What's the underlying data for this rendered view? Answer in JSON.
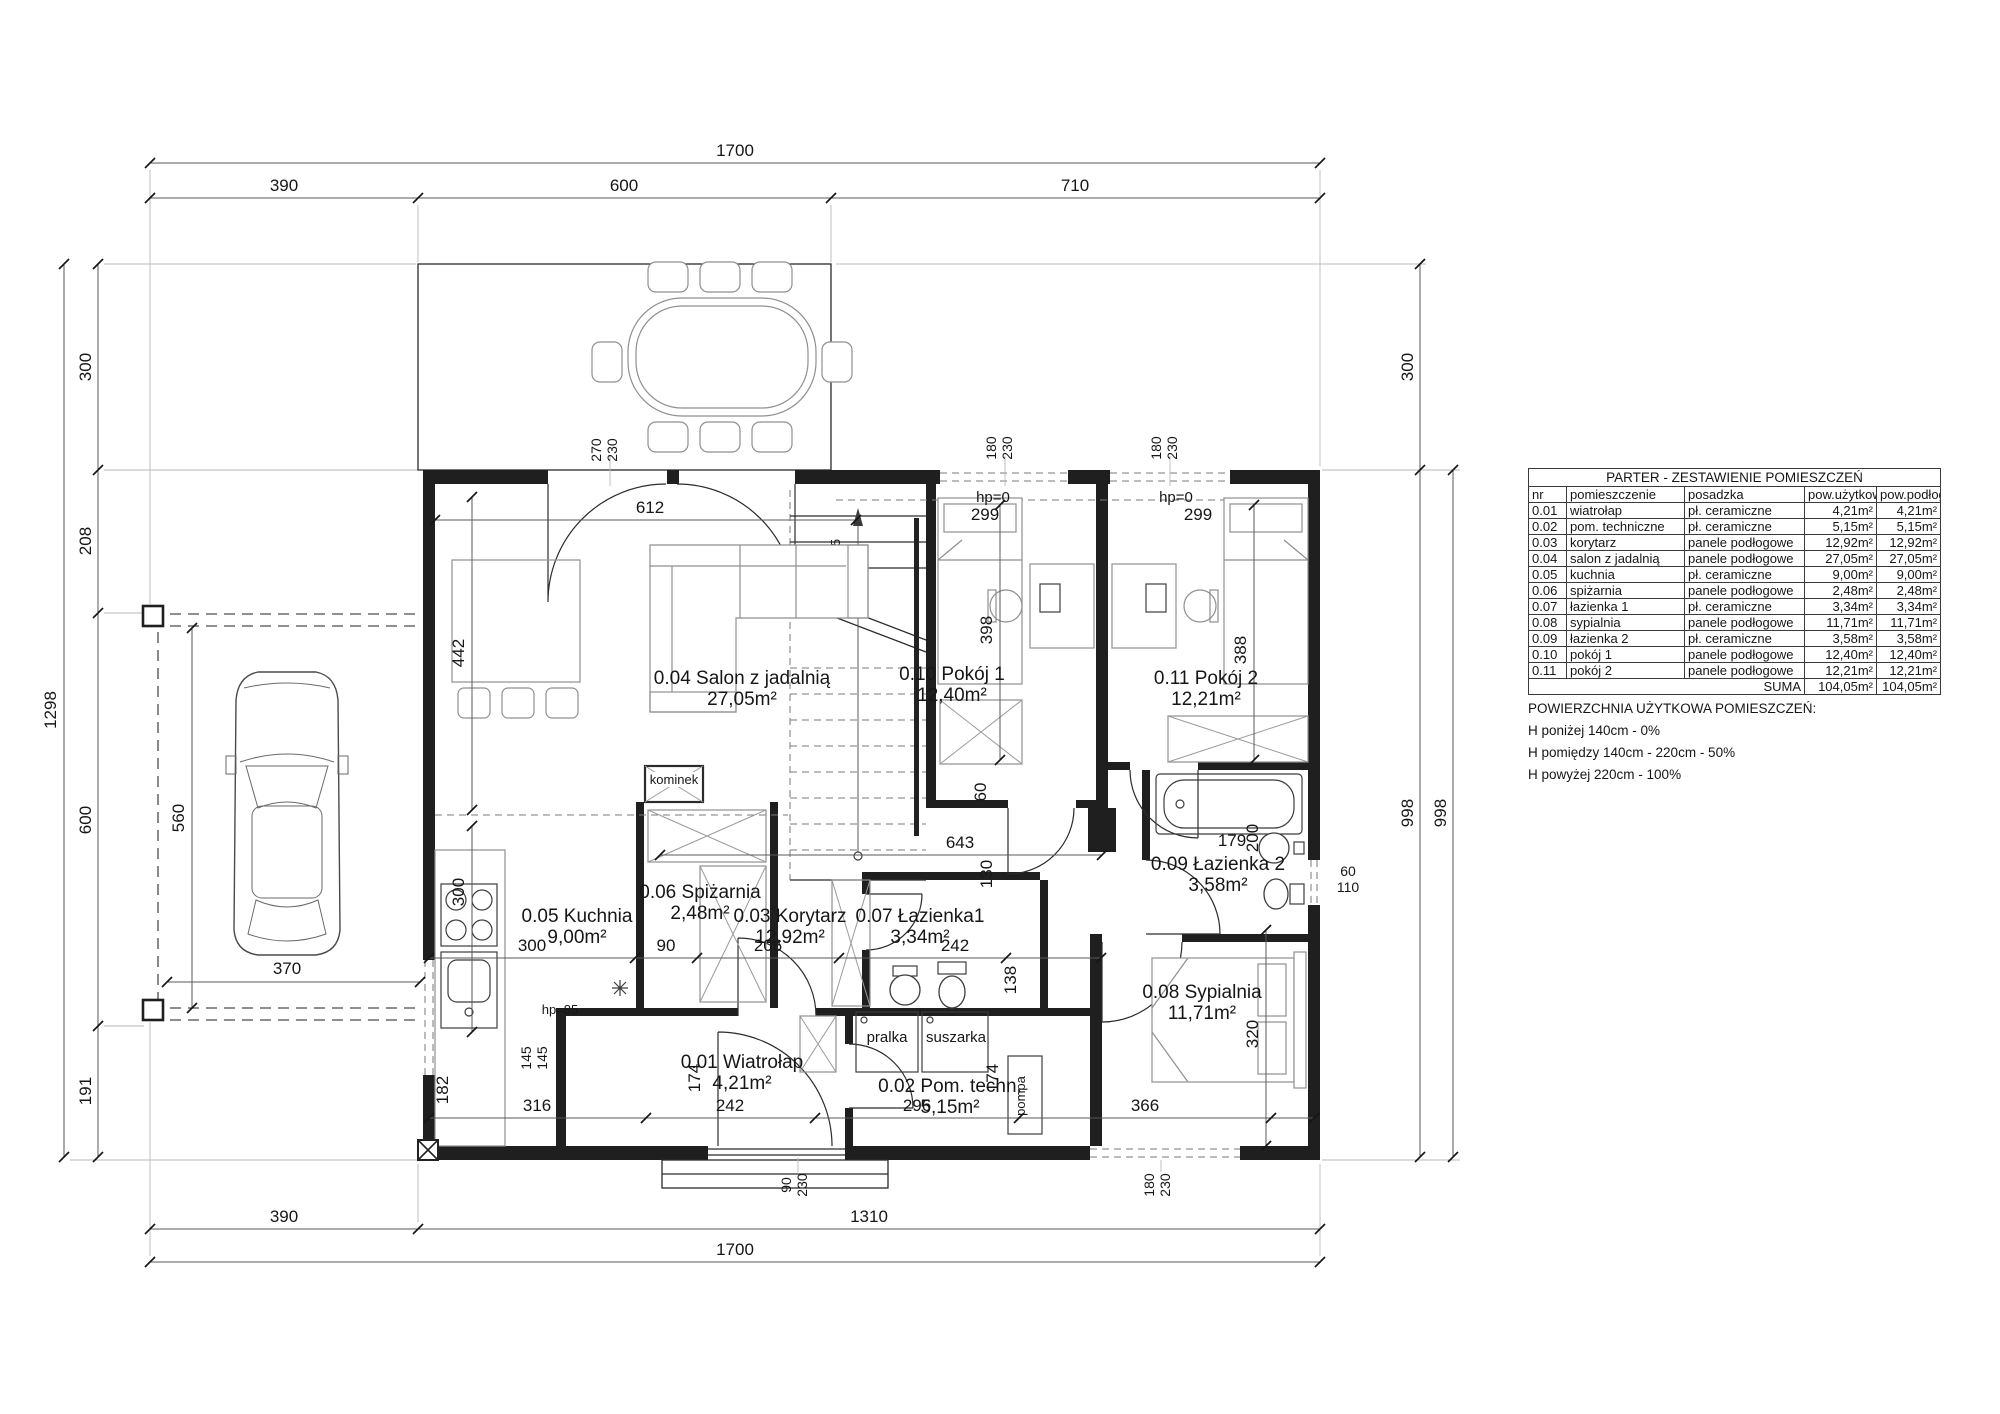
{
  "table": {
    "title": "PARTER - ZESTAWIENIE POMIESZCZEŃ",
    "headers": [
      "nr",
      "pomieszczenie",
      "posadzka",
      "pow.użytkowa",
      "pow.podłogi"
    ],
    "rows": [
      [
        "0.01",
        "wiatrołap",
        "pł. ceramiczne",
        "4,21m²",
        "4,21m²"
      ],
      [
        "0.02",
        "pom. techniczne",
        "pł. ceramiczne",
        "5,15m²",
        "5,15m²"
      ],
      [
        "0.03",
        "korytarz",
        "panele podłogowe",
        "12,92m²",
        "12,92m²"
      ],
      [
        "0.04",
        "salon z jadalnią",
        "panele podłogowe",
        "27,05m²",
        "27,05m²"
      ],
      [
        "0.05",
        "kuchnia",
        "pł. ceramiczne",
        "9,00m²",
        "9,00m²"
      ],
      [
        "0.06",
        "spiżarnia",
        "panele podłogowe",
        "2,48m²",
        "2,48m²"
      ],
      [
        "0.07",
        "łazienka 1",
        "pł. ceramiczne",
        "3,34m²",
        "3,34m²"
      ],
      [
        "0.08",
        "sypialnia",
        "panele podłogowe",
        "11,71m²",
        "11,71m²"
      ],
      [
        "0.09",
        "łazienka 2",
        "pł. ceramiczne",
        "3,58m²",
        "3,58m²"
      ],
      [
        "0.10",
        "pokój 1",
        "panele podłogowe",
        "12,40m²",
        "12,40m²"
      ],
      [
        "0.11",
        "pokój 2",
        "panele podłogowe",
        "12,21m²",
        "12,21m²"
      ]
    ],
    "suma_label": "SUMA",
    "suma_util": "104,05m²",
    "suma_floor": "104,05m²"
  },
  "legend": {
    "title": "POWIERZCHNIA UŻYTKOWA POMIESZCZEŃ:",
    "line1": "H poniżej 140cm - 0%",
    "line2": "H pomiędzy 140cm - 220cm - 50%",
    "line3": "H powyżej 220cm - 100%"
  },
  "rooms": {
    "r01": {
      "label": "0.01 Wiatrołap",
      "area": "4,21m²"
    },
    "r02": {
      "label": "0.02 Pom. techn.",
      "area": "5,15m²"
    },
    "r03": {
      "label": "0.03 Korytarz",
      "area": "12,92m²"
    },
    "r04": {
      "label": "0.04 Salon z jadalnią",
      "area": "27,05m²"
    },
    "r05": {
      "label": "0.05 Kuchnia",
      "area": "9,00m²"
    },
    "r06": {
      "label": "0.06 Spiżarnia",
      "area": "2,48m²"
    },
    "r07": {
      "label": "0.07 Łazienka1",
      "area": "3,34m²"
    },
    "r08": {
      "label": "0.08 Sypialnia",
      "area": "11,71m²"
    },
    "r09": {
      "label": "0.09 Łazienka 2",
      "area": "3,58m²"
    },
    "r10": {
      "label": "0.10 Pokój 1",
      "area": "12,40m²"
    },
    "r11": {
      "label": "0.11 Pokój 2",
      "area": "12,21m²"
    }
  },
  "dims": {
    "d1700": "1700",
    "d390": "390",
    "d600": "600",
    "d710": "710",
    "d1310": "1310",
    "d1298": "1298",
    "d300": "300",
    "d208": "208",
    "d191": "191",
    "d998": "998",
    "d560": "560",
    "d370": "370",
    "d612": "612",
    "d442": "442",
    "d90": "90",
    "d206": "206",
    "d242": "242",
    "d138": "138",
    "d643": "643",
    "d130": "130",
    "d60": "60",
    "d110": "110",
    "d179": "179",
    "d200": "200",
    "d320": "320",
    "d366": "366",
    "d296": "296",
    "d316": "316",
    "d174": "174",
    "d145": "145",
    "d182": "182",
    "d398": "398",
    "d388": "388",
    "d299": "299",
    "d270": "270",
    "d230": "230",
    "d180": "180"
  },
  "ann": {
    "hp0": "hp=0",
    "hp85": "hp=85",
    "stairs1": "17x17,5",
    "stairs2": "28",
    "pralka": "pralka",
    "suszarka": "suszarka",
    "pompa": "pompa",
    "kominek": "kominek"
  }
}
